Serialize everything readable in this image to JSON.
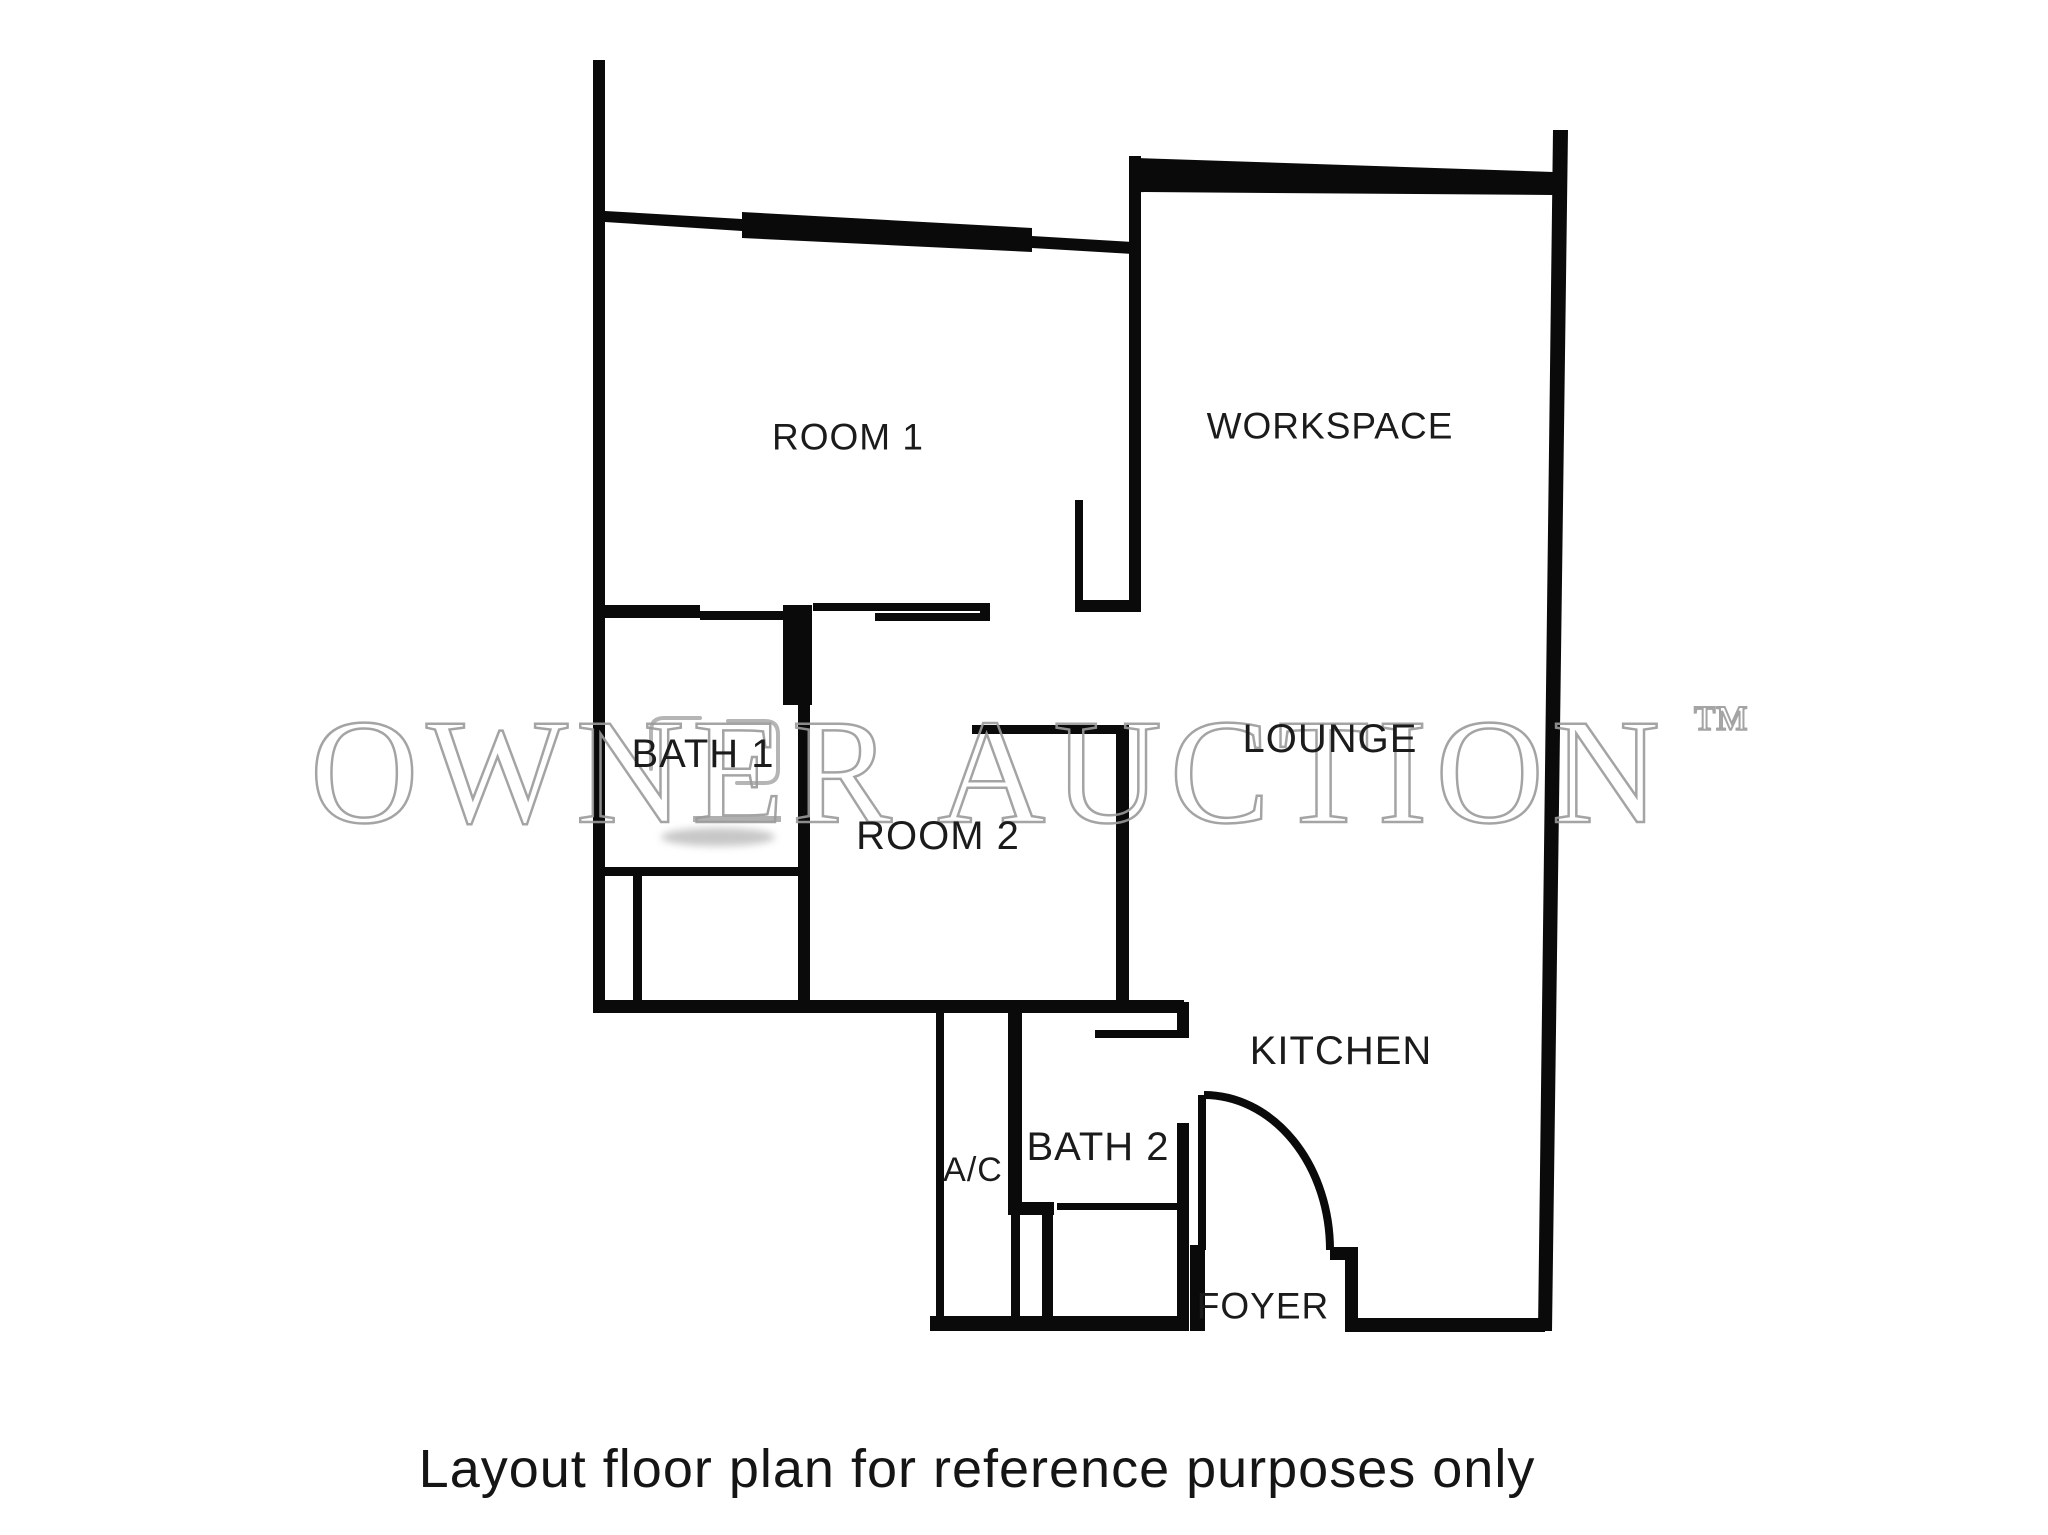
{
  "type": "floor-plan",
  "rooms": {
    "room1": {
      "label": "ROOM 1"
    },
    "workspace": {
      "label": "WORKSPACE"
    },
    "bath1": {
      "label": "BATH 1"
    },
    "room2": {
      "label": "ROOM 2"
    },
    "lounge": {
      "label": "LOUNGE"
    },
    "kitchen": {
      "label": "KITCHEN"
    },
    "ac": {
      "label": "A/C"
    },
    "bath2": {
      "label": "BATH 2"
    },
    "foyer": {
      "label": "FOYER"
    }
  },
  "watermark": {
    "text": "OWNER AUCTION",
    "trademark": "™",
    "color": "#9b9b9b"
  },
  "caption": {
    "text": "Layout floor plan for reference purposes only"
  },
  "colors": {
    "background": "#ffffff",
    "wall": "#0a0a0a",
    "label": "#1b1b1b",
    "watermark": "#9b9b9b"
  }
}
